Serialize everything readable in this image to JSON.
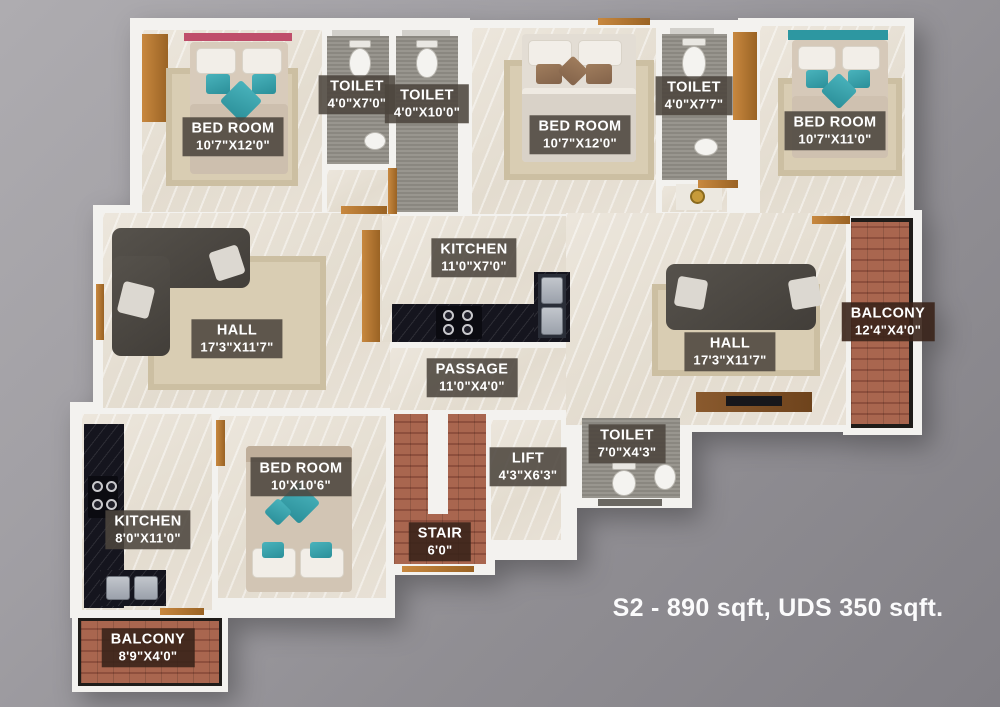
{
  "plan": {
    "caption": "S2 - 890 sqft, UDS 350 sqft.",
    "rooms": {
      "bedroom_tl": {
        "name": "BED ROOM",
        "dims": "10'7\"X12'0\""
      },
      "toilet_1": {
        "name": "TOILET",
        "dims": "4'0\"X7'0\""
      },
      "toilet_2": {
        "name": "TOILET",
        "dims": "4'0\"X10'0\""
      },
      "bedroom_tm": {
        "name": "BED ROOM",
        "dims": "10'7\"X12'0\""
      },
      "toilet_3": {
        "name": "TOILET",
        "dims": "4'0\"X7'7\""
      },
      "bedroom_tr": {
        "name": "BED ROOM",
        "dims": "10'7\"X11'0\""
      },
      "kitchen_c": {
        "name": "KITCHEN",
        "dims": "11'0\"X7'0\""
      },
      "hall_l": {
        "name": "HALL",
        "dims": "17'3\"X11'7\""
      },
      "hall_r": {
        "name": "HALL",
        "dims": "17'3\"X11'7\""
      },
      "balcony_r": {
        "name": "BALCONY",
        "dims": "12'4\"X4'0\""
      },
      "passage": {
        "name": "PASSAGE",
        "dims": "11'0\"X4'0\""
      },
      "bedroom_b": {
        "name": "BED ROOM",
        "dims": "10'X10'6\""
      },
      "toilet_4": {
        "name": "TOILET",
        "dims": "7'0\"X4'3\""
      },
      "lift": {
        "name": "LIFT",
        "dims": "4'3\"X6'3\""
      },
      "kitchen_bl": {
        "name": "KITCHEN",
        "dims": "8'0\"X11'0\""
      },
      "stair": {
        "name": "STAIR",
        "dims": "6'0\""
      },
      "balcony_bl": {
        "name": "BALCONY",
        "dims": "8'9\"X4'0\""
      }
    },
    "colors": {
      "background": "#98969b",
      "wall": "#f3f2ef",
      "marble_floor": "#e7e1d6",
      "toilet_floor": "#918e87",
      "brick": "#a2604e",
      "counter": "#15151e",
      "wood": "#b97a36",
      "accent_teal": "#35a2ac",
      "label_bg": "#4c463e",
      "label_brown_bg": "#3a241a",
      "text": "#ffffff"
    }
  }
}
